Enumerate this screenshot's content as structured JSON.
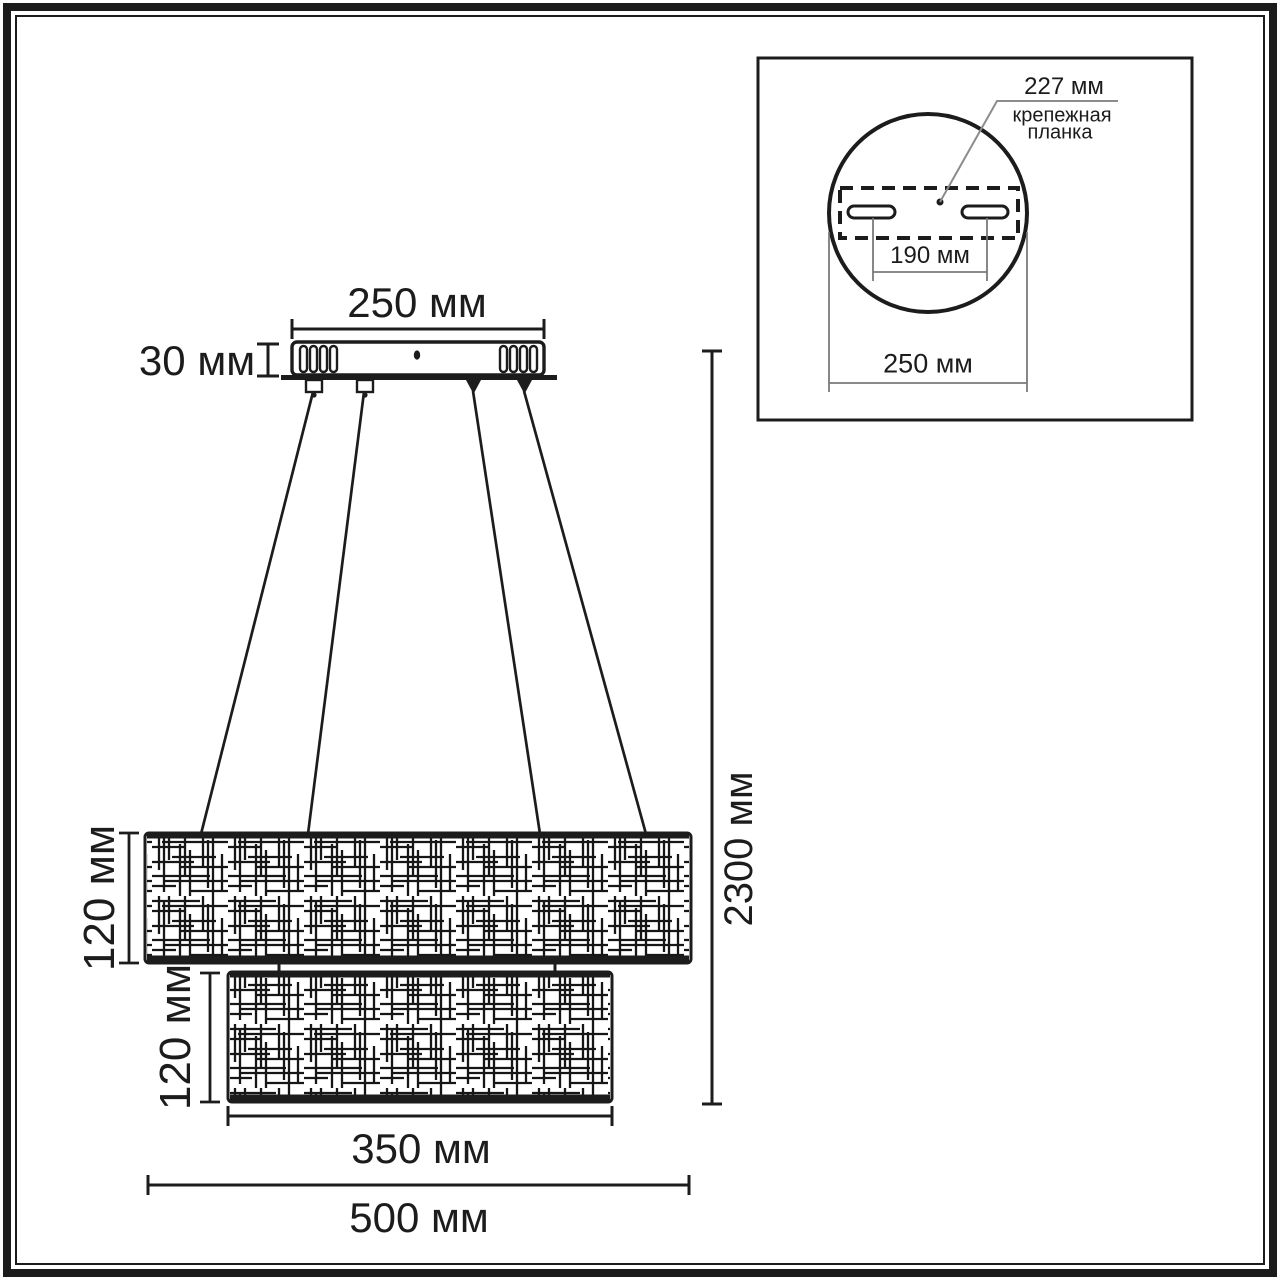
{
  "diagram": {
    "main": {
      "canopy_width": "250 мм",
      "canopy_height": "30 мм",
      "upper_shade_height": "120 мм",
      "lower_shade_height": "120 мм",
      "lower_shade_width": "350 мм",
      "upper_shade_width": "500 мм",
      "suspension_height": "2300 мм"
    },
    "inset": {
      "plate_length_label": "227 мм",
      "plate_caption_line1": "крепежная",
      "plate_caption_line2": "планка",
      "slot_spacing_label": "190 мм",
      "diameter_label": "250 мм"
    },
    "colors": {
      "line": "#1c1c1c",
      "leader": "#8c8c8c",
      "inset_dim": "#7a7a7a",
      "background": "#ffffff"
    }
  }
}
